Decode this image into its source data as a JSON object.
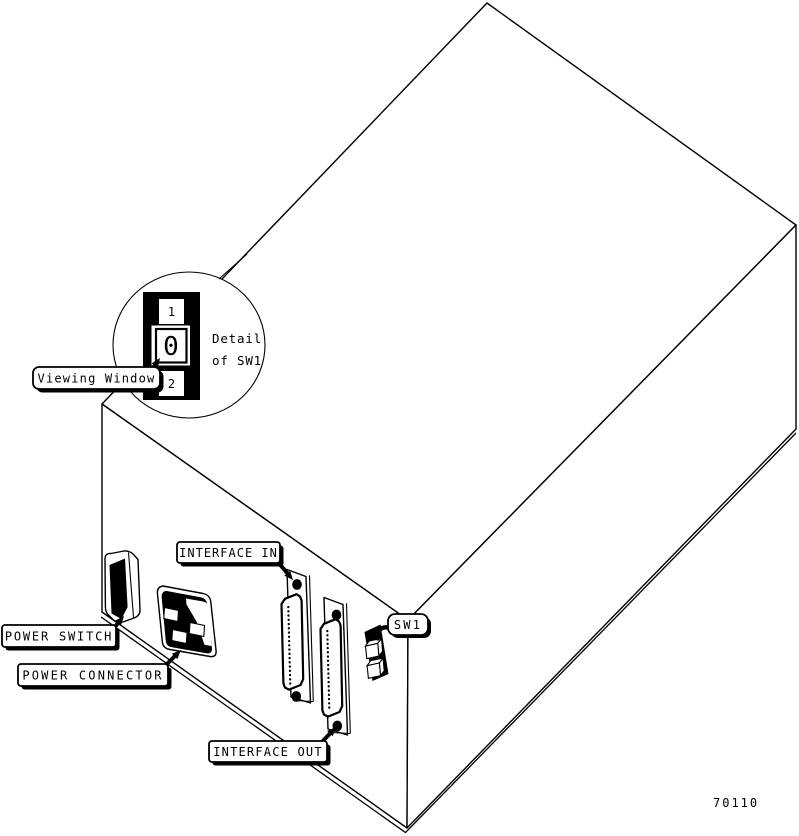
{
  "figure_number": "70110",
  "colors": {
    "ink": "#000000",
    "paper": "#ffffff"
  },
  "labels": {
    "viewing_window": "Viewing Window",
    "power_switch": "POWER SWITCH",
    "power_connector": "POWER CONNECTOR",
    "interface_in": "INTERFACE IN",
    "interface_out": "INTERFACE OUT",
    "sw1": "SW1"
  },
  "detail_callout": {
    "caption_line1": "Detail",
    "caption_line2": "of SW1",
    "positions": [
      "1",
      "0",
      "2"
    ],
    "window_shows": "0"
  }
}
